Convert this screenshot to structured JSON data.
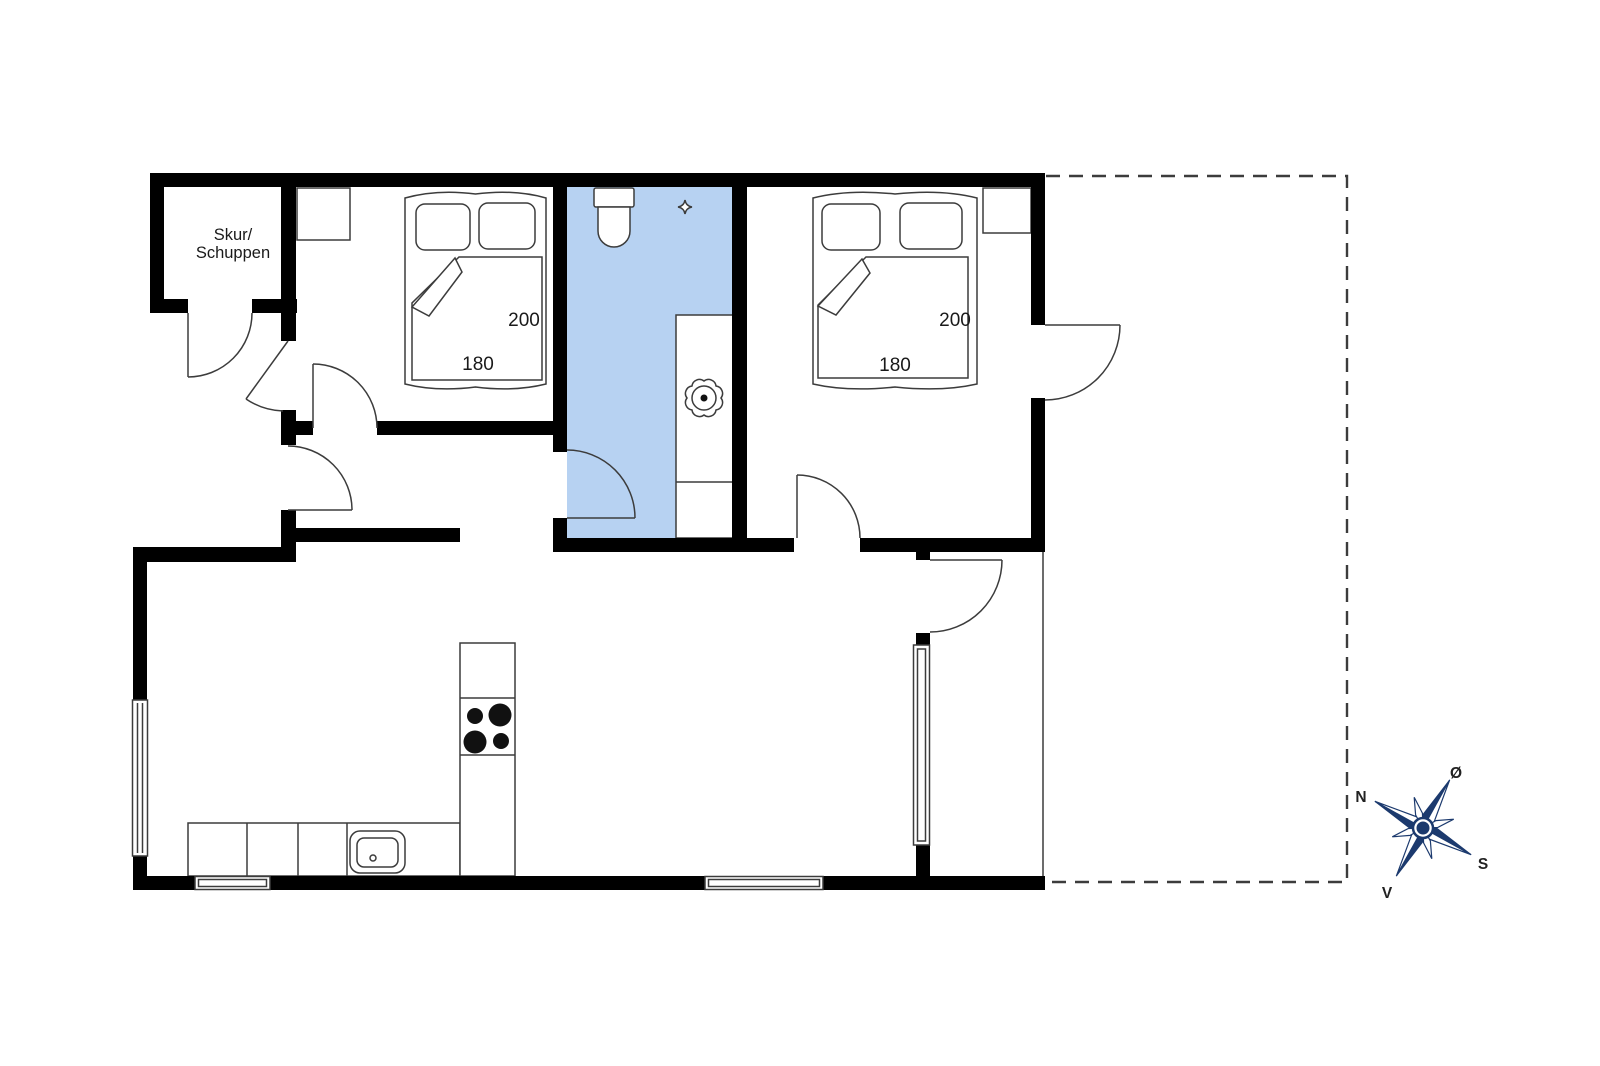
{
  "shed": {
    "line1": "Skur/",
    "line2": "Schuppen"
  },
  "bedroom1": {
    "length": "200",
    "width": "180"
  },
  "bedroom2": {
    "length": "200",
    "width": "180"
  },
  "compass": {
    "north": "N",
    "east": "Ø",
    "south": "S",
    "west": "V"
  },
  "colors": {
    "wall": "#000000",
    "line": "#3c3c3c",
    "bathroom_floor": "#b7d2f2",
    "compass_navy": "#1c3a6e"
  }
}
